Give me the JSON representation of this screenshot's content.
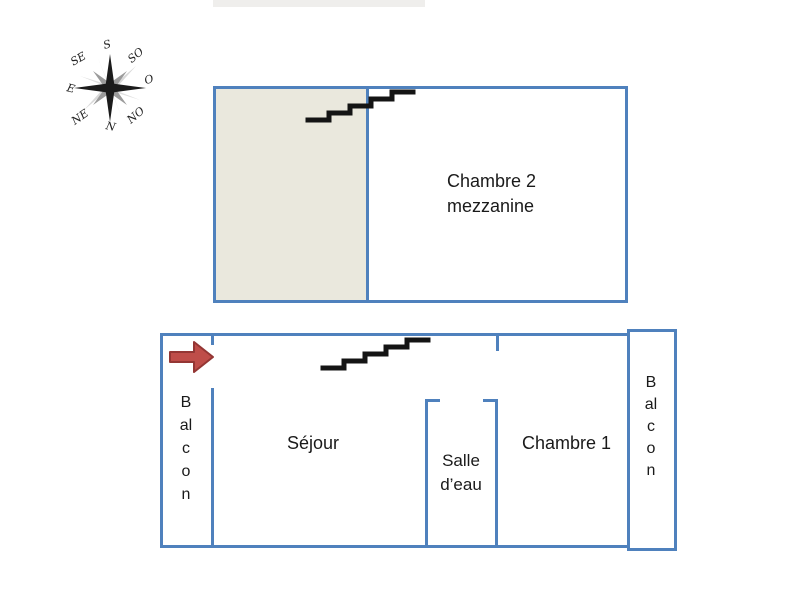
{
  "header": {
    "cropped_title_band": ""
  },
  "compass": {
    "name": "compass-rose",
    "labels": {
      "s": "S",
      "so": "SO",
      "o": "O",
      "no": "NO",
      "n": "N",
      "ne": "NE",
      "e": "E",
      "se": "SE"
    }
  },
  "upper_plan": {
    "room": {
      "line1": "Chambre 2",
      "line2": "mezzanine"
    }
  },
  "lower_plan": {
    "balcony_left": "Balcon",
    "balcony_right": "Balcon",
    "living_room": "Séjour",
    "bathroom": {
      "line1": "Salle",
      "line2": "d’eau"
    },
    "bedroom": "Chambre 1"
  },
  "icons": {
    "compass": "compass-rose",
    "entrance": "red-right-block-arrow",
    "stairs_upper": "staircase",
    "stairs_lower": "staircase"
  },
  "colors": {
    "wall_blue": "#4f81bd",
    "mezzanine_fill": "#eae8dd",
    "arrow_fill": "#bf4d49",
    "arrow_stroke": "#943634",
    "stairs": "#141414",
    "text": "#1a1a1a",
    "top_band": "#efeeec"
  }
}
